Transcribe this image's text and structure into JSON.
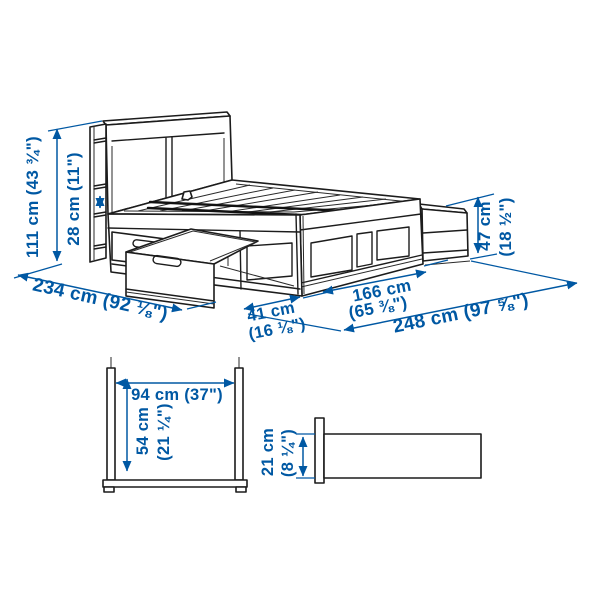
{
  "image": {
    "title": "Bed frame with headboard storage — dimension diagram"
  },
  "colors": {
    "dimension_blue": "#0058a3",
    "line_black": "#1c1c1c",
    "background": "#ffffff"
  },
  "labels": {
    "total_height": "111 cm (43 ¾\")",
    "headboard_depth": "28 cm (11\")",
    "bed_length": "234 cm (92 ⅛\")",
    "drawer_pullout_cm": "41 cm",
    "drawer_pullout_in": "(16 ⅛\")",
    "bed_width_cm": "166 cm",
    "bed_width_in": "(65 ⅜\")",
    "total_clearance_width": "248 cm (97 ⅝\")",
    "footboard_height_cm": "47 cm",
    "footboard_height_in": "(18 ½\")",
    "drawer_inner_width": "94 cm (37\")",
    "drawer_inner_depth_cm": "54 cm",
    "drawer_inner_depth_in": "(21 ¼\")",
    "base_height_cm": "21 cm",
    "base_height_in": "(8 ¼\")"
  }
}
